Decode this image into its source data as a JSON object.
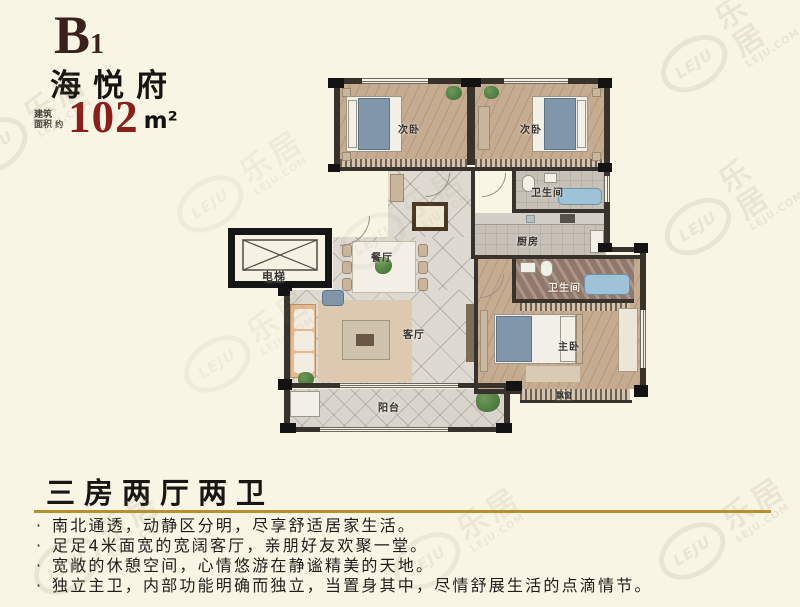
{
  "header": {
    "unit": "B",
    "unit_num": "1",
    "project": "海悦府",
    "area_label_l1": "建筑",
    "area_label_l2": "面积",
    "area_approx": "约",
    "area_value": "102",
    "area_unit": "m²"
  },
  "plan": {
    "rooms": [
      {
        "id": "bedroom-left",
        "label": "次卧"
      },
      {
        "id": "bedroom-right",
        "label": "次卧"
      },
      {
        "id": "bath-top",
        "label": "卫生间"
      },
      {
        "id": "kitchen",
        "label": "厨房"
      },
      {
        "id": "bath-master",
        "label": "卫生间"
      },
      {
        "id": "master-bedroom",
        "label": "主卧"
      },
      {
        "id": "elevator",
        "label": "电梯"
      },
      {
        "id": "dining",
        "label": "餐厅"
      },
      {
        "id": "living",
        "label": "客厅"
      },
      {
        "id": "balcony",
        "label": "阳台"
      },
      {
        "id": "bay-window",
        "label": "飘窗"
      }
    ]
  },
  "summary": {
    "title": "三房两厅两卫",
    "bullet_marker": "·",
    "bullets": [
      "南北通透，动静区分明，尽享舒适居家生活。",
      "足足4米面宽的宽阔客厅，亲朋好友欢聚一堂。",
      "宽敞的休憩空间，心情悠游在静谧精美的天地。",
      "独立主卫，内部功能明确而独立，当置身其中，尽情舒展生活的点滴情节。"
    ]
  },
  "watermark": {
    "oval_text": "LEJU",
    "cn_text": "乐居",
    "site_text": "LEJU.COM"
  },
  "colors": {
    "background": "#f9f5e5",
    "title_dark_red": "#3a211d",
    "area_red": "#8c1d18",
    "gold_underline": "#b8912f",
    "wall": "#38322c"
  }
}
